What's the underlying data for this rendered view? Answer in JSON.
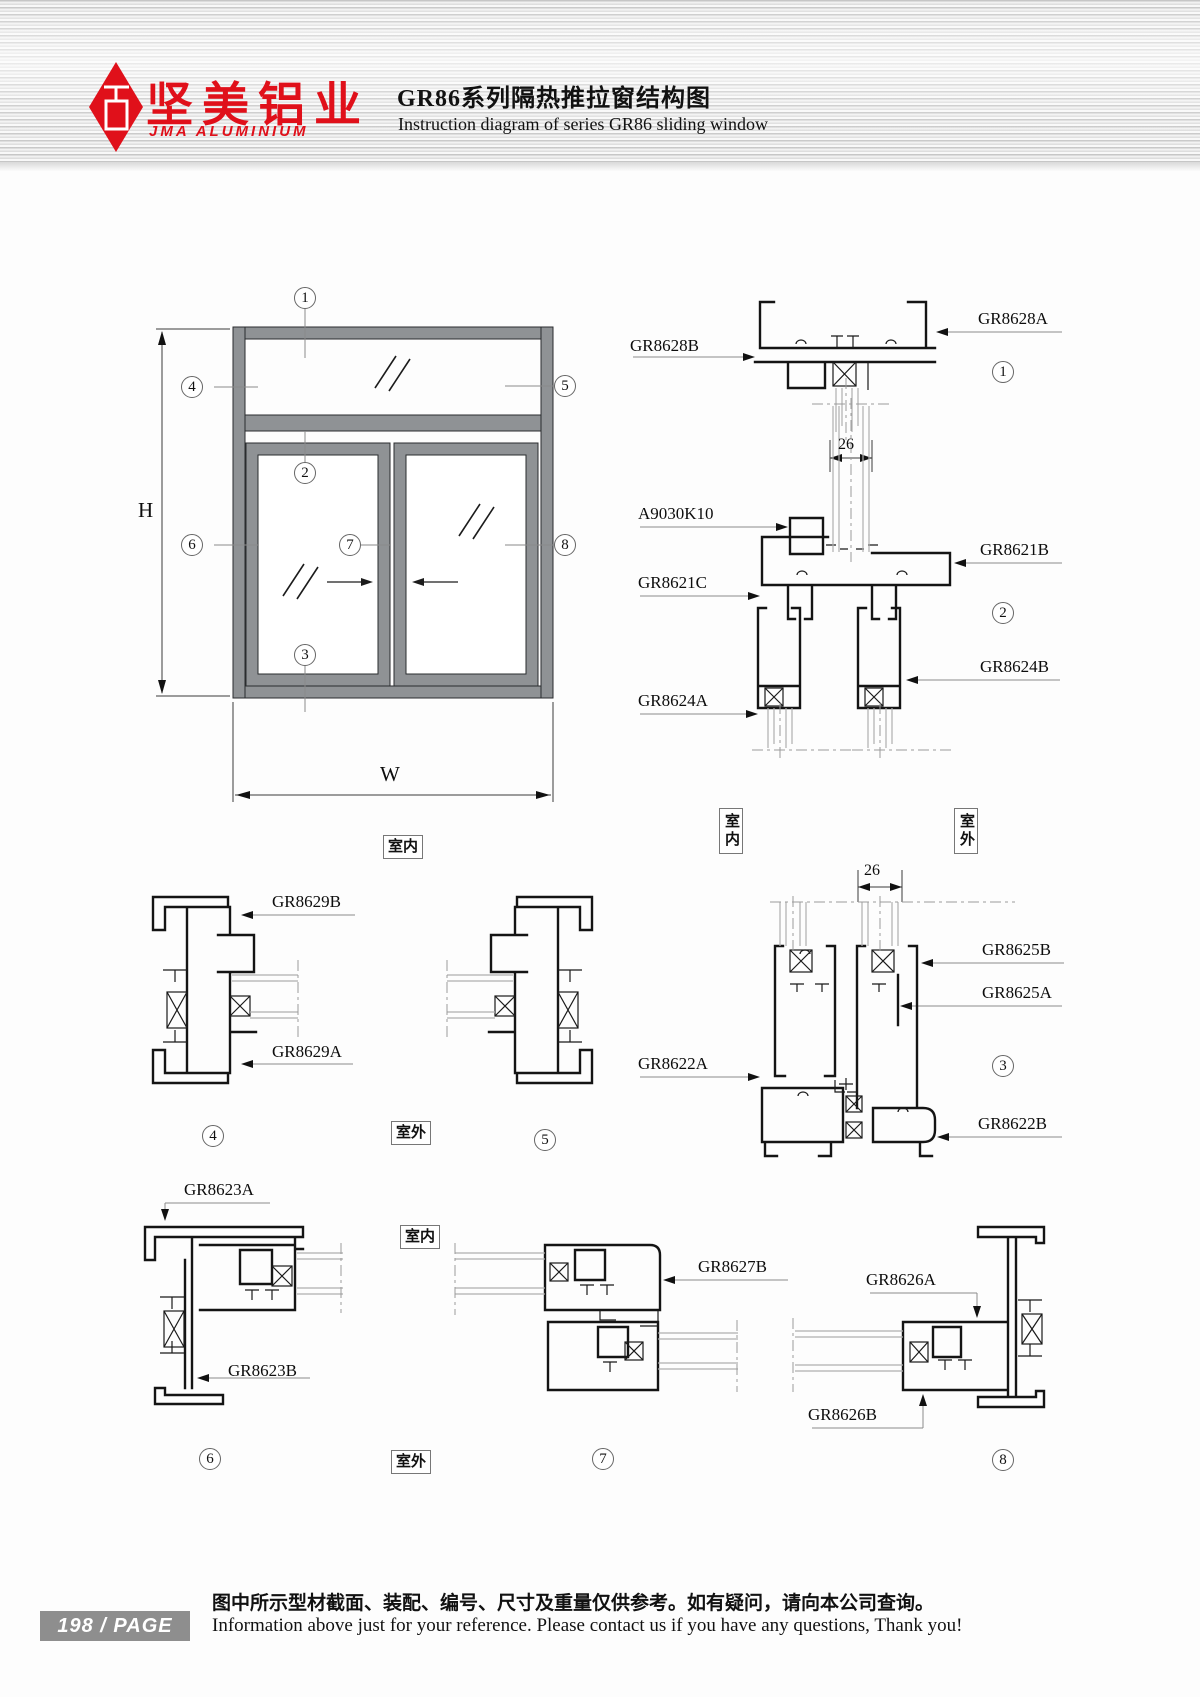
{
  "header": {
    "logo_cn": "坚美铝业",
    "logo_en": "JMA ALUMINIUM",
    "title_cn": "GR86系列隔热推拉窗结构图",
    "title_en": "Instruction diagram of series GR86 sliding window"
  },
  "colors": {
    "brand_red": "#e0101a",
    "line_black": "#141414",
    "frame_gray": "#8f9295",
    "glass_gray": "#b0b0b0"
  },
  "elevation": {
    "dim_h": "H",
    "dim_w": "W",
    "room": "室内",
    "callouts": [
      "1",
      "2",
      "3",
      "4",
      "5",
      "6",
      "7",
      "8"
    ]
  },
  "rooms": {
    "indoor": "室内",
    "outdoor": "室外"
  },
  "dims": {
    "glass_gap": "26"
  },
  "sections": {
    "s1": {
      "num": "1",
      "gr8628b": "GR8628B",
      "gr8628a": "GR8628A"
    },
    "s2": {
      "num": "2",
      "a9030k10": "A9030K10",
      "gr8621c": "GR8621C",
      "gr8621b": "GR8621B",
      "gr8624a": "GR8624A",
      "gr8624b": "GR8624B"
    },
    "s3": {
      "num": "3",
      "gr8625b": "GR8625B",
      "gr8625a": "GR8625A",
      "gr8622a": "GR8622A",
      "gr8622b": "GR8622B"
    },
    "s4": {
      "num": "4",
      "gr8629b": "GR8629B",
      "gr8629a": "GR8629A"
    },
    "s5": {
      "num": "5"
    },
    "s6": {
      "num": "6",
      "gr8623a": "GR8623A",
      "gr8623b": "GR8623B"
    },
    "s7": {
      "num": "7",
      "gr8627b": "GR8627B"
    },
    "s8": {
      "num": "8",
      "gr8626a": "GR8626A",
      "gr8626b": "GR8626B"
    }
  },
  "footer": {
    "page_badge": "198 / PAGE",
    "note_cn": "图中所示型材截面、装配、编号、尺寸及重量仅供参考。如有疑问，请向本公司查询。",
    "note_en": "Information above just for your reference. Please contact us if you have any questions, Thank you!"
  }
}
